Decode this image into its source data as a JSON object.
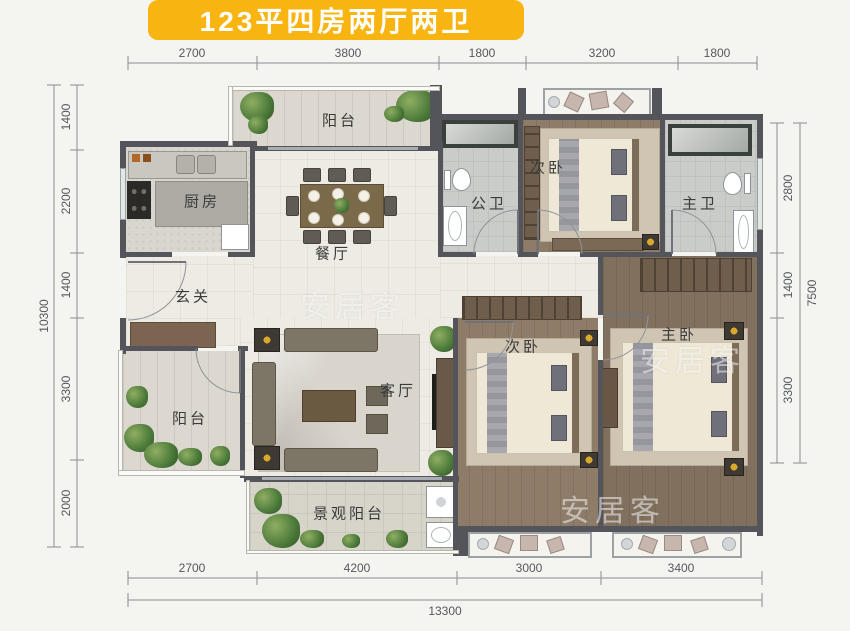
{
  "title": "123平四房两厅两卫",
  "watermark": "安居客",
  "colors": {
    "banner": "#F8B411",
    "banner_text": "#FFFFFF",
    "wall": "#54555A"
  },
  "dimensions": {
    "top": [
      "2700",
      "3800",
      "1800",
      "3200",
      "1800"
    ],
    "bottom": [
      "2700",
      "4200",
      "3000",
      "3400"
    ],
    "bottom_total": "13300",
    "left": [
      "1400",
      "2200",
      "1400",
      "3300",
      "2000"
    ],
    "left_total": "10300",
    "right": [
      "2800",
      "1400",
      "3300"
    ],
    "right_total": "7500"
  },
  "rooms": {
    "balcony_top": "阳台",
    "kitchen": "厨房",
    "dining": "餐厅",
    "foyer": "玄关",
    "public_bath": "公卫",
    "bedroom_top": "次卧",
    "master_bath": "主卫",
    "living": "客厅",
    "balcony_left": "阳台",
    "landscape_balcony": "景观阳台",
    "bedroom_second": "次卧",
    "master_bedroom": "主卧"
  }
}
